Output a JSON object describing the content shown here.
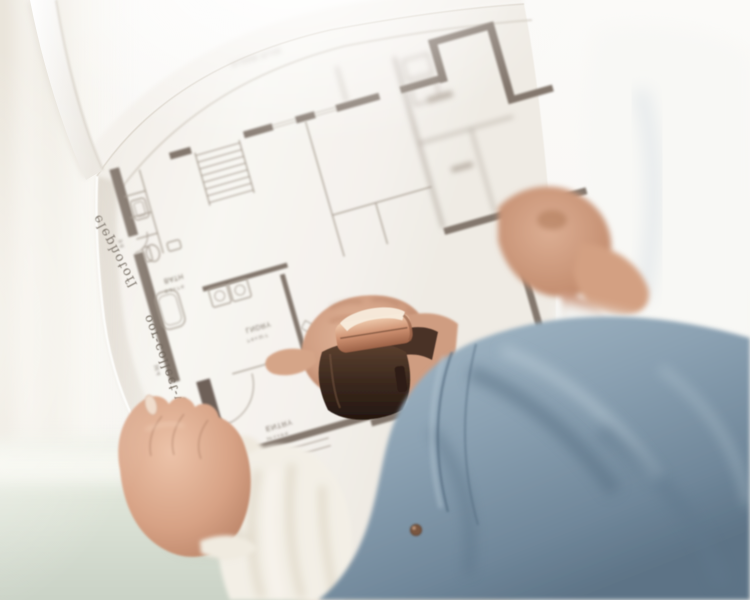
{
  "plan": {
    "title": "FLOOR PLAN",
    "edge_text_upper": "elephotofl",
    "edge_text_lower": "oor-collect-wall",
    "rooms": {
      "bath": {
        "label": "BATH",
        "dim": "5'-3 x 7'-6"
      },
      "laundry": {
        "label": "LNDRY",
        "dim": "7'-6 x 11'-7"
      },
      "entry": {
        "label": "ENTRY",
        "dim": "14'-1 x 9'-6"
      }
    },
    "dimensions": {
      "left_upper": "9'-8",
      "left_lower": "16'-4"
    },
    "colors": {
      "wall": "#83776d",
      "wall_dark": "#6e6158",
      "line": "#a89e93",
      "label": "#7d7368",
      "paper": "#f6f4f0"
    }
  },
  "photo": {
    "colors": {
      "denim": "#8ba1b2",
      "denim_shadow": "#566e82",
      "denim_highlight": "#c3d3dd",
      "skin": "#d7a285",
      "skin_shadow": "#a5705a",
      "watch_case_gold": "#cf9272",
      "watch_strap_brown": "#3a281d",
      "blouse_white": "#f3efe6",
      "wall_sage": "#d5dccf",
      "window_white": "#faf9f6"
    }
  }
}
